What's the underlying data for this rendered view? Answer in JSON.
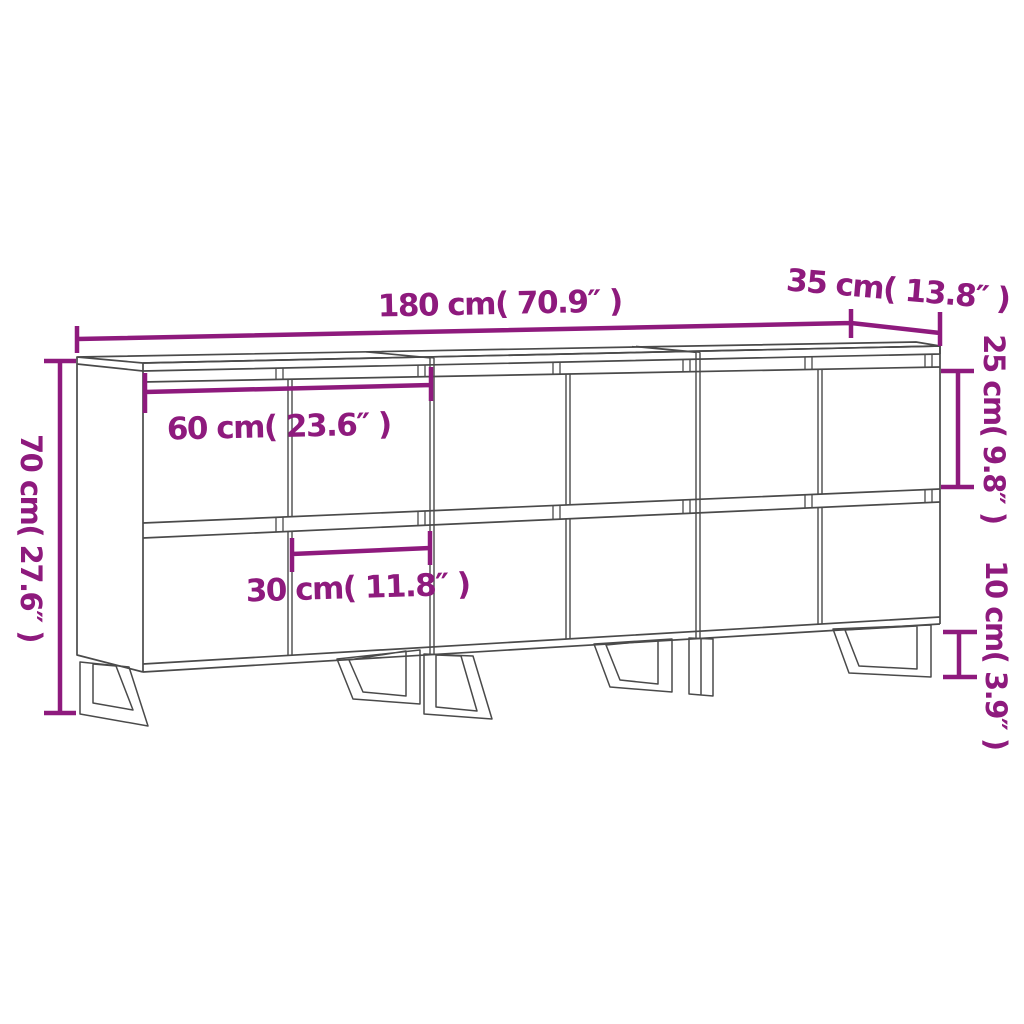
{
  "title": "Sideboard 3-unit dimension diagram",
  "colors": {
    "accent": "#8E1A7D",
    "line": "#4A4A4A",
    "background": "#FFFFFF"
  },
  "product": {
    "units": 3,
    "door_columns": 6,
    "door_rows": 2,
    "legs": 6
  },
  "dimensions": {
    "total_width": "180 cm( 70.9″ )",
    "depth": "35 cm( 13.8″ )",
    "upper_door_height": "25 cm( 9.8″ )",
    "total_height": "70 cm( 27.6″ )",
    "unit_width": "60 cm( 23.6″ )",
    "door_width": "30 cm( 11.8″ )",
    "leg_height": "10 cm( 3.9″ )"
  }
}
